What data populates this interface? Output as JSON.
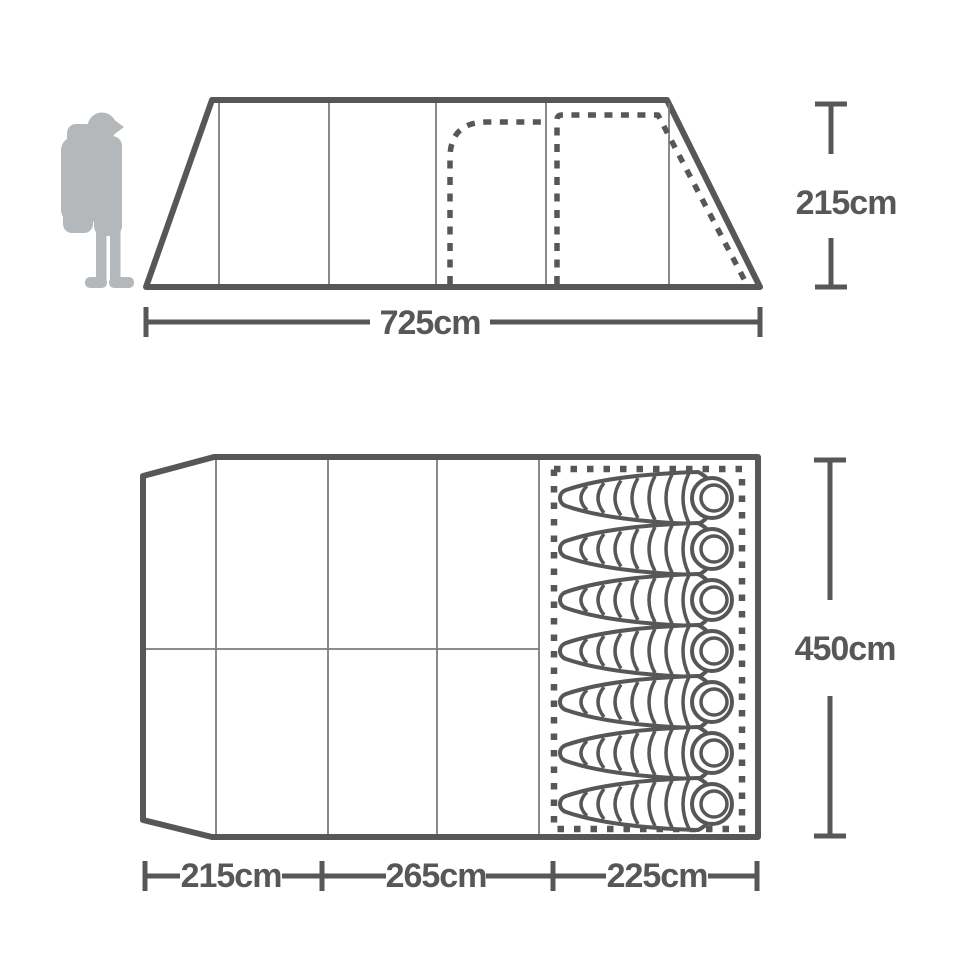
{
  "side_view": {
    "height_label": "215cm",
    "width_label": "725cm"
  },
  "floor_plan": {
    "depth_label": "450cm",
    "section_labels": [
      {
        "label": "215cm"
      },
      {
        "label": "265cm"
      },
      {
        "label": "225cm"
      }
    ],
    "sleeping_bag_count": 7
  },
  "icons": {
    "scale_figure": "hiker-with-backpack-silhouette",
    "sleeping_area": "sleeping-bag-icon"
  },
  "colors": {
    "line": "#555759",
    "thin_line": "#7b7c7f",
    "silhouette": "#b5b8ba",
    "background": "#ffffff"
  }
}
